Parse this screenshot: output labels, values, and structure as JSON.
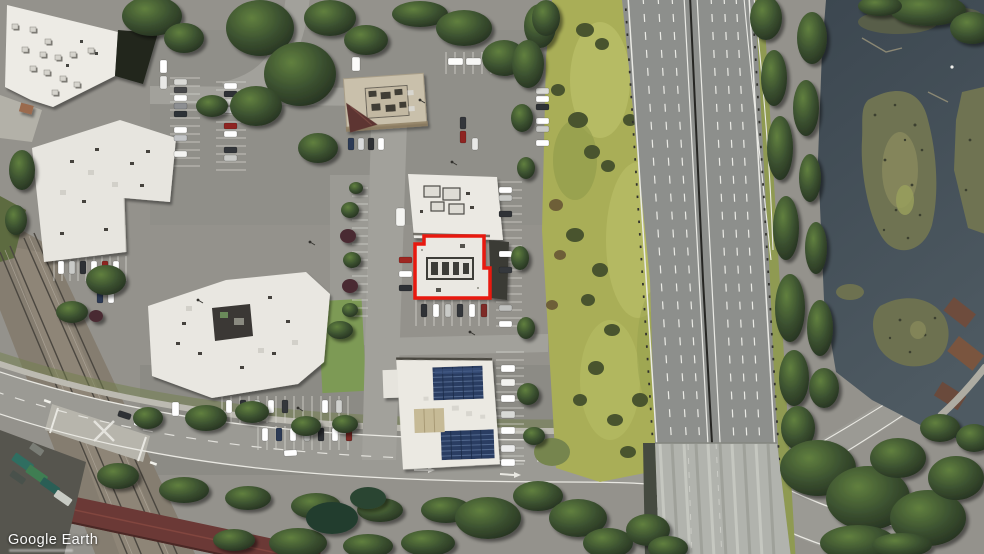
{
  "meta": {
    "view": "satellite-aerial",
    "width_px": 984,
    "height_px": 554
  },
  "watermark": {
    "brand": "Google Earth"
  },
  "parcel_highlight": {
    "color": "#e8190f",
    "stroke_px": 3.5,
    "label": "red outline around highlighted retail building"
  },
  "palette": {
    "asphalt": "#94928c",
    "roof_white": "#ebe9e3",
    "meadow_grass": "#a9ae57",
    "tree_canopy": "#2d3b26",
    "highway_pavement": "#8d8f8c",
    "bridge_deck": "#b1b3ad",
    "water": "#414c56",
    "marsh_island": "#6f7352",
    "solar_panel": "#2b3e62",
    "maroon_roof": "#6b3936",
    "lane_marking": "#eaeae5"
  },
  "scene": {
    "features": [
      "office buildings with white roofs",
      "retail building outlined in red",
      "parking lots with cars",
      "railroad tracks with grade crossing",
      "multilane freeway with bridge deck",
      "meadow buffer strip",
      "wetland water with marsh islands",
      "tree cover"
    ]
  }
}
